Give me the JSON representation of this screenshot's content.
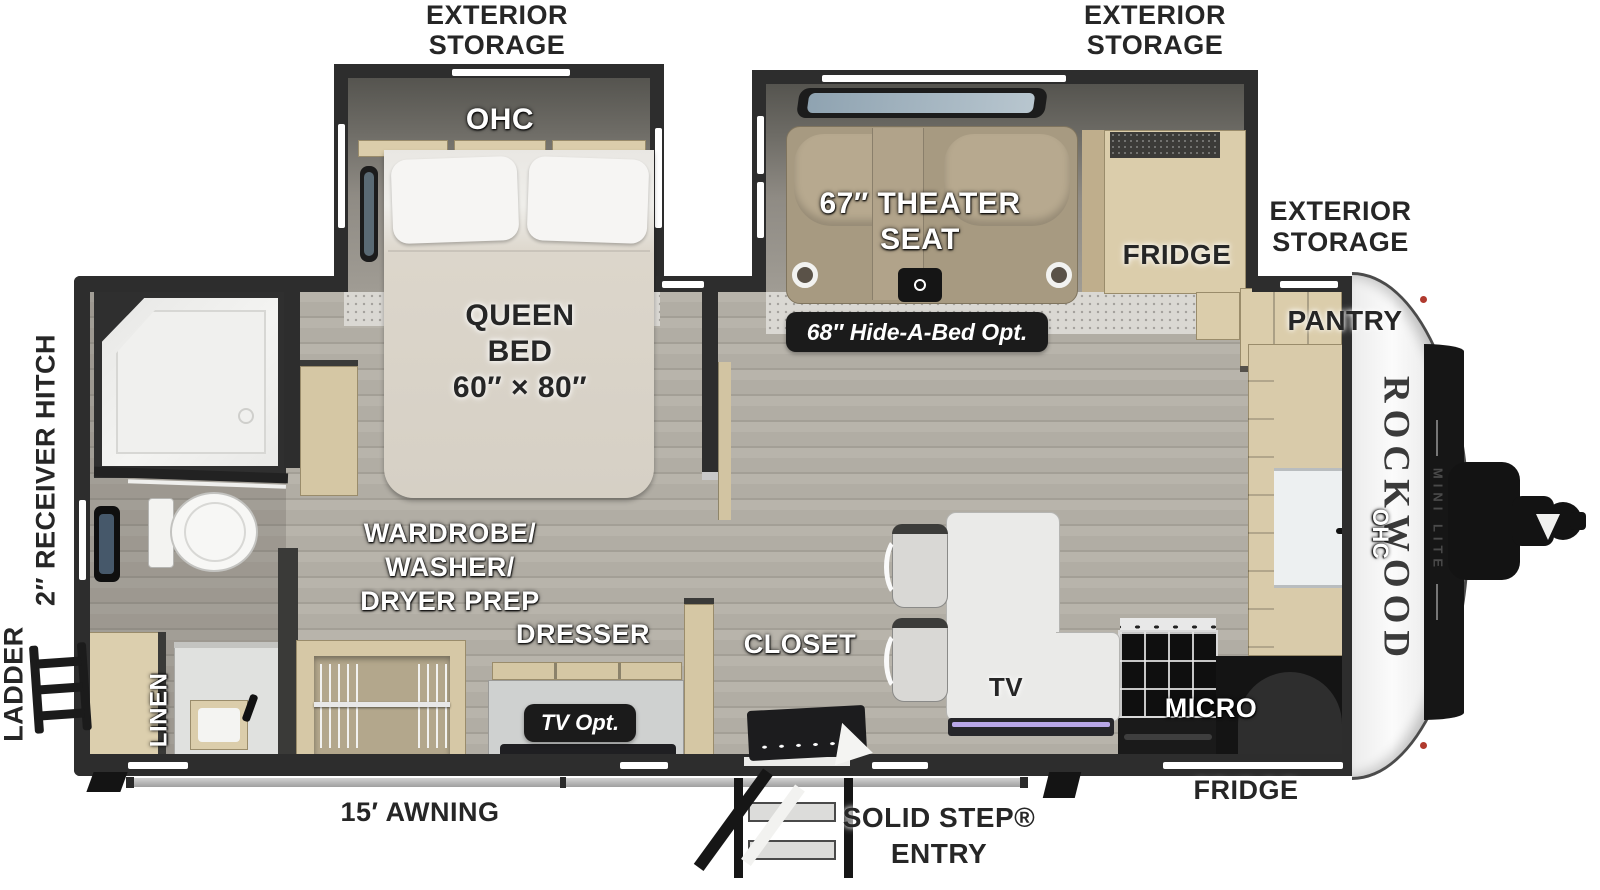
{
  "plan": {
    "brand": {
      "name": "ROCKWOOD",
      "sub": "MINI LITE"
    },
    "exterior": {
      "storage_bed_slide": [
        "EXTERIOR",
        "STORAGE"
      ],
      "storage_theater_slide": [
        "EXTERIOR",
        "STORAGE"
      ],
      "storage_front": [
        "EXTERIOR",
        "STORAGE"
      ],
      "receiver_hitch": "2″ RECEIVER HITCH",
      "ladder": "LADDER",
      "awning": "15′ AWNING",
      "entry": [
        "SOLID STEP®",
        "ENTRY"
      ],
      "fridge_door_side": "FRIDGE"
    },
    "rooms": {
      "bedroom": {
        "ohc": "OHC",
        "bed": [
          "QUEEN",
          "BED",
          "60″ × 80″"
        ],
        "wardrobe": [
          "WARDROBE/",
          "WASHER/",
          "DRYER PREP"
        ],
        "dresser": "DRESSER",
        "tv_option": "TV Opt."
      },
      "bathroom": {
        "linen": "LINEN"
      },
      "living": {
        "theater_seat": [
          "67″ THEATER",
          "SEAT"
        ],
        "hide_a_bed_option": "68″ Hide-A-Bed Opt.",
        "fridge": "FRIDGE",
        "closet": "CLOSET",
        "tv": "TV"
      },
      "kitchen": {
        "pantry": "PANTRY",
        "micro": "MICRO",
        "ohc": "OHC"
      }
    },
    "colors": {
      "wall": "#2d2d2d",
      "floor_wood": "#b3afa6",
      "carpet": "#dad8d3",
      "cabinet_tan": "#dbcdab",
      "seat_tan": "#a79a81",
      "mattress": "#d9d3c8",
      "counter_white": "#eaeae8",
      "badge_black": "#1b1b1b",
      "tv_glow": "#b9a7e8",
      "marker_red": "#b03a2e"
    }
  }
}
